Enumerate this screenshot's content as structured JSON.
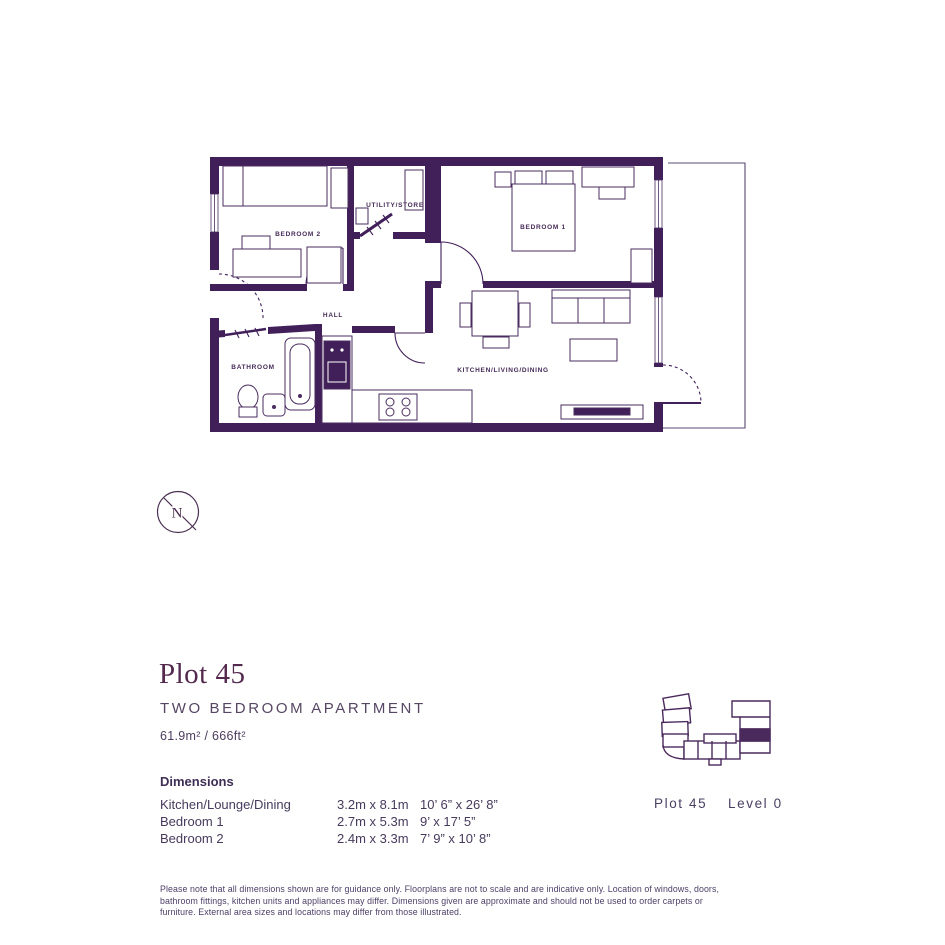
{
  "floorplan": {
    "rooms": [
      {
        "id": "bedroom2",
        "label": "BEDROOM 2"
      },
      {
        "id": "utility",
        "label": "UTILITY/STORE"
      },
      {
        "id": "bedroom1",
        "label": "BEDROOM 1"
      },
      {
        "id": "hall",
        "label": "HALL"
      },
      {
        "id": "bathroom",
        "label": "BATHROOM"
      },
      {
        "id": "kitchen",
        "label": "KITCHEN/LIVING/DINING"
      }
    ],
    "compass": {
      "label": "N"
    }
  },
  "details": {
    "title": "Plot 45",
    "subtitle": "TWO BEDROOM APARTMENT",
    "area": "61.9m² / 666ft²"
  },
  "dimensions": {
    "heading": "Dimensions",
    "rows": [
      {
        "name": "Kitchen/Lounge/Dining",
        "metric": "3.2m x 8.1m",
        "imperial": "10’ 6” x 26’ 8”"
      },
      {
        "name": "Bedroom 1",
        "metric": "2.7m x 5.3m",
        "imperial": "9’ x 17’ 5”"
      },
      {
        "name": "Bedroom 2",
        "metric": "2.4m x 3.3m",
        "imperial": "7’ 9” x 10’ 8”"
      }
    ]
  },
  "locator": {
    "plot_label": "Plot 45",
    "level_label": "Level 0"
  },
  "disclaimer": "Please note that all dimensions shown are for guidance only. Floorplans are not to scale and are indicative only. Location of windows, doors, bathroom fittings, kitchen units and appliances may differ. Dimensions given are approximate and should not be used to order carpets or furniture. External area sizes and locations may differ from those illustrated.",
  "colors": {
    "wall": "#41205a",
    "accent_title": "#53294e",
    "thin_line": "#5a4870",
    "body_text": "#473a5c"
  }
}
